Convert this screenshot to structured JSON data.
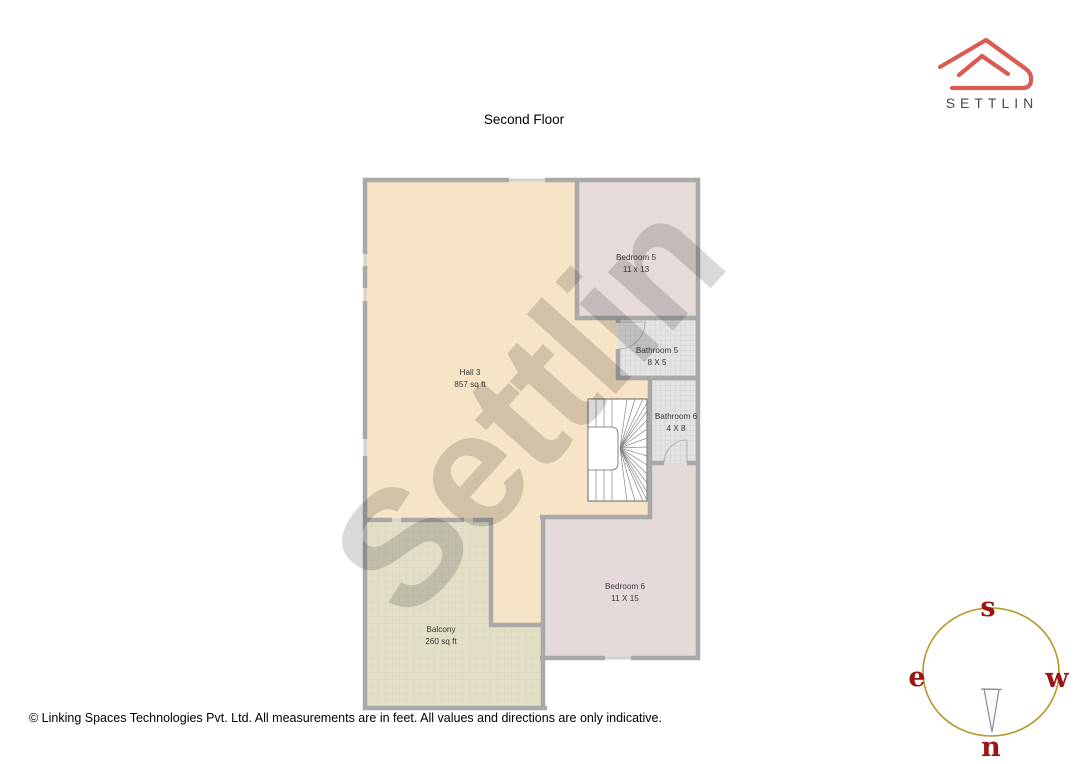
{
  "page": {
    "title": "Second Floor",
    "footer": "© Linking Spaces Technologies Pvt. Ltd. All measurements are in feet. All values and directions are only indicative."
  },
  "brand": {
    "name": "SETTLIN",
    "logo_color": "#d95b51",
    "text_color": "#4a4a4a"
  },
  "watermark": {
    "text": "Settlin"
  },
  "floor_plan": {
    "floor": "Second Floor",
    "wall_color": "#a9a9a9",
    "window_color": "#d2d2d2",
    "rooms": [
      {
        "name": "Hall 3",
        "size": "857 sq ft",
        "fill": "#f7e3c5"
      },
      {
        "name": "Bedroom 5",
        "size": "11 x 13",
        "fill": "#e7dbda"
      },
      {
        "name": "Bathroom 5",
        "size": "8 X 5",
        "fill": "#e3e3e3"
      },
      {
        "name": "Bathroom 6",
        "size": "4 X 8",
        "fill": "#e3e3e3"
      },
      {
        "name": "Bedroom 6",
        "size": "11 X 15",
        "fill": "#e5d9d9"
      },
      {
        "name": "Balcony",
        "size": "260 sq ft",
        "fill": "#e2dfc7"
      }
    ],
    "features": [
      "winder-staircase",
      "doors",
      "windows"
    ]
  },
  "compass": {
    "top": "s",
    "left": "e",
    "right": "w",
    "bottom": "n",
    "ring_color": "#b3992b",
    "letter_color": "#9c1515"
  }
}
